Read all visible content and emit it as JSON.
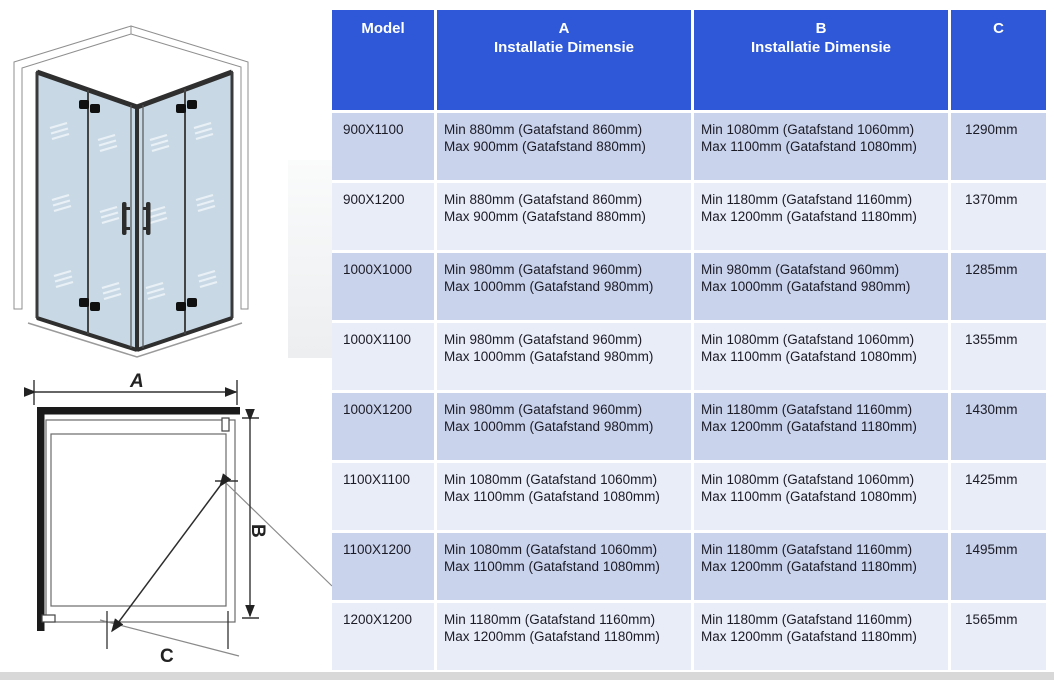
{
  "table": {
    "header": {
      "model": "Model",
      "col_a_letter": "A",
      "col_a_sub": "Installatie Dimensie",
      "col_b_letter": "B",
      "col_b_sub": "Installatie Dimensie",
      "col_c": "C"
    },
    "rows": [
      {
        "model": "900X1100",
        "a_min": "Min 880mm (Gatafstand 860mm)",
        "a_max": "Max 900mm (Gatafstand 880mm)",
        "b_min": "Min 1080mm (Gatafstand 1060mm)",
        "b_max": "Max 1100mm (Gatafstand 1080mm)",
        "c": "1290mm"
      },
      {
        "model": "900X1200",
        "a_min": "Min 880mm (Gatafstand 860mm)",
        "a_max": "Max 900mm (Gatafstand 880mm)",
        "b_min": "Min 1180mm (Gatafstand 1160mm)",
        "b_max": "Max 1200mm (Gatafstand 1180mm)",
        "c": "1370mm"
      },
      {
        "model": "1000X1000",
        "a_min": "Min 980mm (Gatafstand 960mm)",
        "a_max": "Max 1000mm (Gatafstand 980mm)",
        "b_min": "Min 980mm (Gatafstand 960mm)",
        "b_max": "Max 1000mm (Gatafstand 980mm)",
        "c": "1285mm"
      },
      {
        "model": "1000X1100",
        "a_min": "Min 980mm (Gatafstand 960mm)",
        "a_max": "Max 1000mm (Gatafstand 980mm)",
        "b_min": "Min 1080mm (Gatafstand 1060mm)",
        "b_max": "Max 1100mm (Gatafstand 1080mm)",
        "c": "1355mm"
      },
      {
        "model": "1000X1200",
        "a_min": "Min 980mm (Gatafstand 960mm)",
        "a_max": "Max 1000mm (Gatafstand 980mm)",
        "b_min": "Min 1180mm (Gatafstand 1160mm)",
        "b_max": "Max 1200mm (Gatafstand 1180mm)",
        "c": "1430mm"
      },
      {
        "model": "1100X1100",
        "a_min": "Min 1080mm (Gatafstand 1060mm)",
        "a_max": "Max 1100mm (Gatafstand 1080mm)",
        "b_min": "Min 1080mm (Gatafstand 1060mm)",
        "b_max": "Max 1100mm (Gatafstand 1080mm)",
        "c": "1425mm"
      },
      {
        "model": "1100X1200",
        "a_min": "Min 1080mm (Gatafstand 1060mm)",
        "a_max": "Max 1100mm (Gatafstand 1080mm)",
        "b_min": "Min 1180mm (Gatafstand 1160mm)",
        "b_max": "Max 1200mm (Gatafstand 1180mm)",
        "c": "1495mm"
      },
      {
        "model": "1200X1200",
        "a_min": "Min 1180mm (Gatafstand 1160mm)",
        "a_max": "Max 1200mm (Gatafstand 1180mm)",
        "b_min": "Min 1180mm (Gatafstand 1160mm)",
        "b_max": "Max 1200mm (Gatafstand 1180mm)",
        "c": "1565mm"
      }
    ]
  },
  "diagram": {
    "dim_a": "A",
    "dim_b": "B",
    "dim_c": "C"
  },
  "colors": {
    "header_bg": "#2e58d8",
    "header_text": "#ffffff",
    "row_dark": "#c9d3ec",
    "row_light": "#e9edf7",
    "glass": "#c8d9e5",
    "frame": "#3a3a3a",
    "bottom_bar": "#d8d8d8"
  }
}
